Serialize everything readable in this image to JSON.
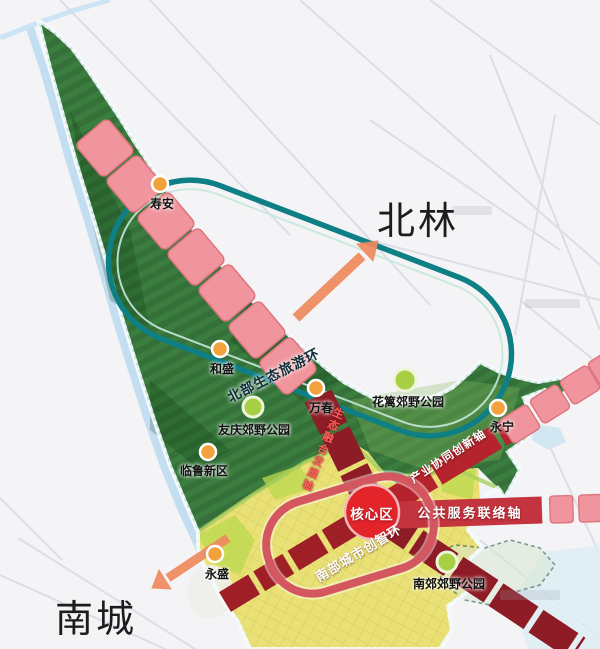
{
  "zones": {
    "north": {
      "label": "北林"
    },
    "south": {
      "label": "南城"
    }
  },
  "core_area": {
    "label": "核心区",
    "color": "#e3242b"
  },
  "rings": {
    "north_eco_tourism": {
      "label": "北部生态旅游环",
      "color": "#0d7f85"
    },
    "south_city_innovation": {
      "label": "南部城市创智环",
      "color": "#d4575f"
    }
  },
  "axes": {
    "eco_integration": {
      "label": "生态融合发展轴",
      "color": "#8e1c26"
    },
    "industry_innovation": {
      "label": "产业协同创新轴",
      "color": "#a32028"
    },
    "public_service": {
      "label": "公共服务联络轴",
      "color": "#c4343f"
    }
  },
  "towns": [
    {
      "name": "寿安",
      "x": 160,
      "y": 184
    },
    {
      "name": "和盛",
      "x": 220,
      "y": 349
    },
    {
      "name": "万春",
      "x": 316,
      "y": 388
    },
    {
      "name": "临鲁新区",
      "x": 208,
      "y": 452
    },
    {
      "name": "永宁",
      "x": 498,
      "y": 408
    },
    {
      "name": "永盛",
      "x": 215,
      "y": 554
    }
  ],
  "parks": [
    {
      "name": "友庆郊野公园",
      "x": 253,
      "y": 407
    },
    {
      "name": "花篱郊野公园",
      "x": 405,
      "y": 380
    },
    {
      "name": "南郊郊野公园",
      "x": 447,
      "y": 562
    }
  ],
  "map_colors": {
    "forest": "#3a7d3e",
    "urban": "#e9e176",
    "water": "#bcdcf0",
    "town_dot": "#f2a23c",
    "park_dot": "#a6cf43",
    "arrow": "#ef8a5f",
    "pink_block": "#f0959d"
  }
}
